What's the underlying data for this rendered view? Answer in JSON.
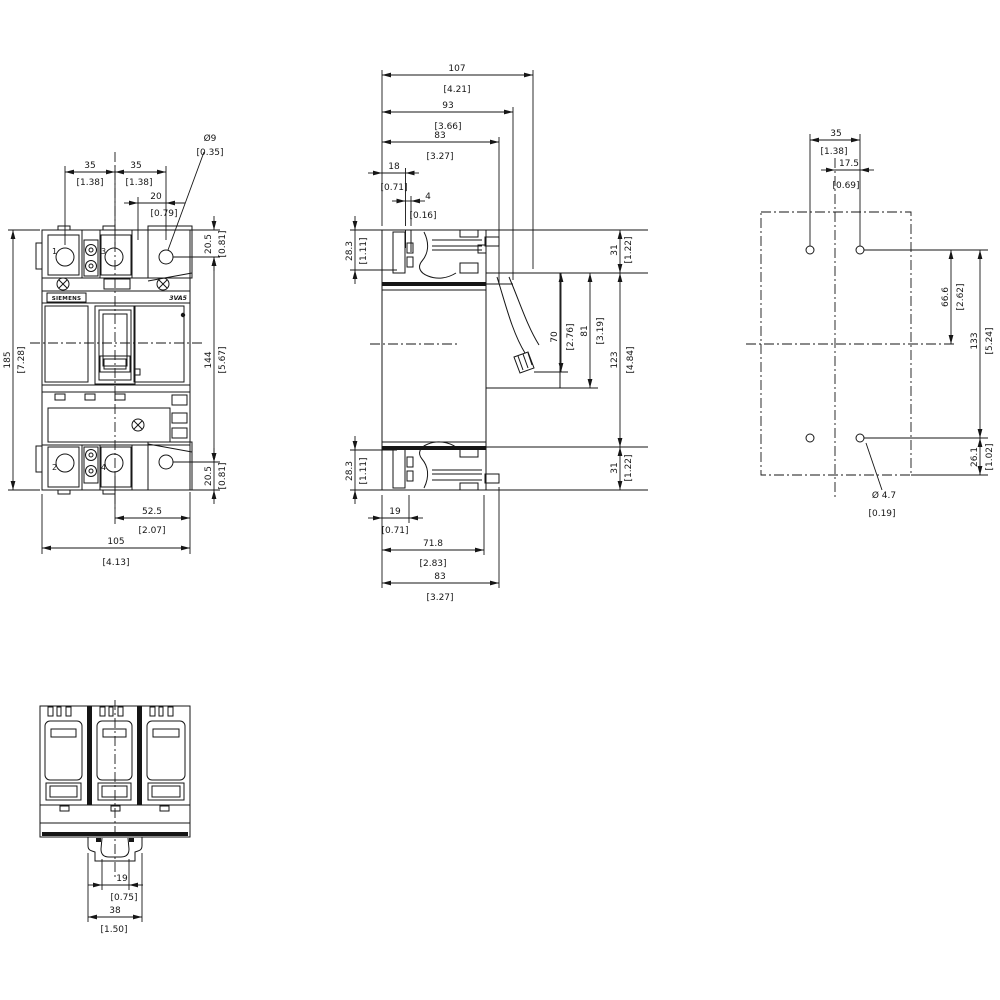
{
  "front_view": {
    "product_brand": "SIEMENS",
    "product_model": "3VA5",
    "terminals": {
      "t1": "1",
      "t2": "2",
      "t3": "3",
      "t4": "4"
    },
    "dims": {
      "pitch_left": {
        "mm": "35",
        "in": "[1.38]"
      },
      "pitch_right": {
        "mm": "35",
        "in": "[1.38]"
      },
      "hole_offset": {
        "mm": "20",
        "in": "[0.79]"
      },
      "hole_dia": {
        "mm": "Ø9",
        "in": "[0.35]"
      },
      "depth_top": {
        "mm": "20.5",
        "in": "[0.81]"
      },
      "height": {
        "mm": "185",
        "in": "[7.28]"
      },
      "hole_span": {
        "mm": "144",
        "in": "[5.67]"
      },
      "depth_bottom": {
        "mm": "20.5",
        "in": "[0.81]"
      },
      "offset_bottom": {
        "mm": "52.5",
        "in": "[2.07]"
      },
      "width": {
        "mm": "105",
        "in": "[4.13]"
      }
    }
  },
  "side_view": {
    "dims": {
      "depth_107": {
        "mm": "107",
        "in": "[4.21]"
      },
      "depth_93": {
        "mm": "93",
        "in": "[3.66]"
      },
      "depth_83_top": {
        "mm": "83",
        "in": "[3.27]"
      },
      "front_18": {
        "mm": "18",
        "in": "[0.71]"
      },
      "step_4": {
        "mm": "4",
        "in": "[0.16]"
      },
      "term_28_top": {
        "mm": "28.3",
        "in": "[1.11]"
      },
      "edge_31_top": {
        "mm": "31",
        "in": "[1.22]"
      },
      "handle_70": {
        "mm": "70",
        "in": "[2.76]"
      },
      "handle_81": {
        "mm": "81",
        "in": "[3.19]"
      },
      "span_123": {
        "mm": "123",
        "in": "[4.84]"
      },
      "edge_31_bot": {
        "mm": "31",
        "in": "[1.22]"
      },
      "term_28_bot": {
        "mm": "28.3",
        "in": "[1.11]"
      },
      "rail_19": {
        "mm": "19",
        "in": "[0.71]"
      },
      "depth_71_8": {
        "mm": "71.8",
        "in": "[2.83]"
      },
      "depth_83_bot": {
        "mm": "83",
        "in": "[3.27]"
      }
    }
  },
  "drill_pattern": {
    "dims": {
      "pitch_35": {
        "mm": "35",
        "in": "[1.38]"
      },
      "half_17_5": {
        "mm": "17.5",
        "in": "[0.69]"
      },
      "center_66_6": {
        "mm": "66.6",
        "in": "[2.62]"
      },
      "span_133": {
        "mm": "133",
        "in": "[5.24]"
      },
      "edge_26_1": {
        "mm": "26.1",
        "in": "[1.02]"
      },
      "hole_dia": {
        "mm": "Ø 4.7",
        "in": "[0.19]"
      }
    }
  },
  "bottom_view": {
    "dims": {
      "rail_19": {
        "mm": "19",
        "in": "[0.75]"
      },
      "clip_38": {
        "mm": "38",
        "in": "[1.50]"
      }
    }
  }
}
